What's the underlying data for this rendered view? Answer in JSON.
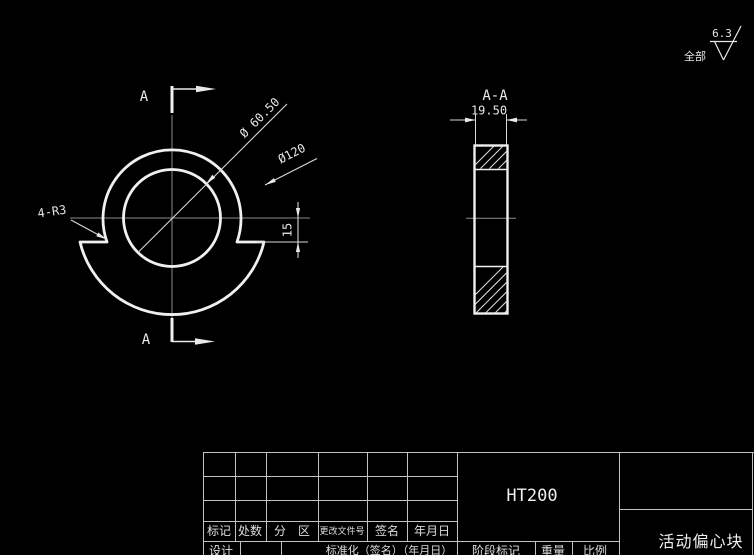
{
  "colors": {
    "background": "#000000",
    "outline": "#f0f0f0",
    "dimension_line": "#d8d8d8",
    "centerline": "#8c8c8c",
    "table_line": "#c2c2c2"
  },
  "surface_note": {
    "scope_label": "全部",
    "roughness_value": "6.3"
  },
  "main_view": {
    "section_arrow_top_label": "A",
    "section_arrow_bottom_label": "A",
    "dim_hole_diameter": "Ø 60.50",
    "dim_outer_diameter": "Ø120",
    "dim_fillet": "4-R3",
    "dim_offset": "15"
  },
  "section_view": {
    "title": "A-A",
    "dim_thickness": "19.50"
  },
  "title_block": {
    "revision_headers": [
      "标记",
      "处数",
      "分　区",
      "更改文件号",
      "签名",
      "年月日"
    ],
    "material": "HT200",
    "part_name": "活动偏心块",
    "row_design_label": "设计",
    "row_standardization_label": "标准化（签名）（年月日）",
    "row_stage_label": "阶段标记",
    "row_weight_label": "重量",
    "row_scale_label": "比例"
  }
}
